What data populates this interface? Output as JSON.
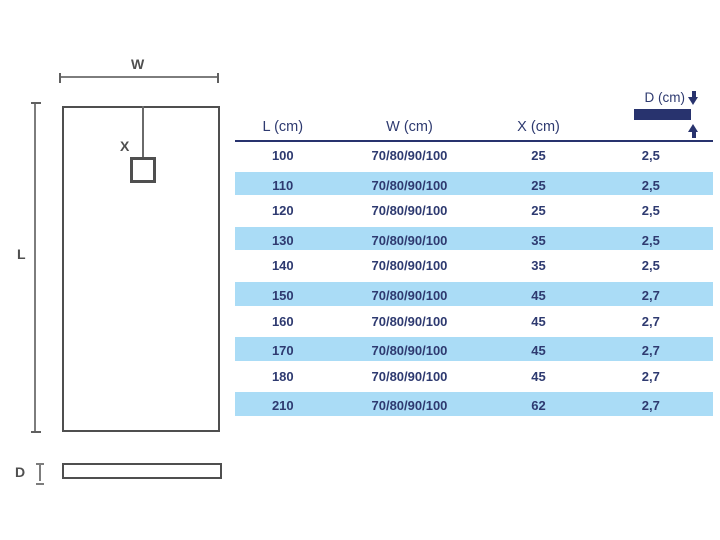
{
  "colors": {
    "navy_text": "#2e3a70",
    "navy_solid": "#28336e",
    "row_highlight_blue": "#aadcf6",
    "diagram_line_dark": "#4f4f4f",
    "diagram_line_dim": "#7d7d7d"
  },
  "diagram": {
    "width_label": "W",
    "length_label": "L",
    "drain_offset_label": "X",
    "depth_label": "D"
  },
  "table": {
    "headers": {
      "l": "L (cm)",
      "w": "W (cm)",
      "x": "X (cm)",
      "d": "D (cm)"
    },
    "rows": [
      {
        "l": "100",
        "w": "70/80/90/100",
        "x": "25",
        "d": "2,5",
        "highlight": false
      },
      {
        "l": "110",
        "w": "70/80/90/100",
        "x": "25",
        "d": "2,5",
        "highlight": true
      },
      {
        "l": "120",
        "w": "70/80/90/100",
        "x": "25",
        "d": "2,5",
        "highlight": false
      },
      {
        "l": "130",
        "w": "70/80/90/100",
        "x": "35",
        "d": "2,5",
        "highlight": true
      },
      {
        "l": "140",
        "w": "70/80/90/100",
        "x": "35",
        "d": "2,5",
        "highlight": false
      },
      {
        "l": "150",
        "w": "70/80/90/100",
        "x": "45",
        "d": "2,7",
        "highlight": true
      },
      {
        "l": "160",
        "w": "70/80/90/100",
        "x": "45",
        "d": "2,7",
        "highlight": false
      },
      {
        "l": "170",
        "w": "70/80/90/100",
        "x": "45",
        "d": "2,7",
        "highlight": true
      },
      {
        "l": "180",
        "w": "70/80/90/100",
        "x": "45",
        "d": "2,7",
        "highlight": false
      },
      {
        "l": "210",
        "w": "70/80/90/100",
        "x": "62",
        "d": "2,7",
        "highlight": true
      }
    ]
  }
}
